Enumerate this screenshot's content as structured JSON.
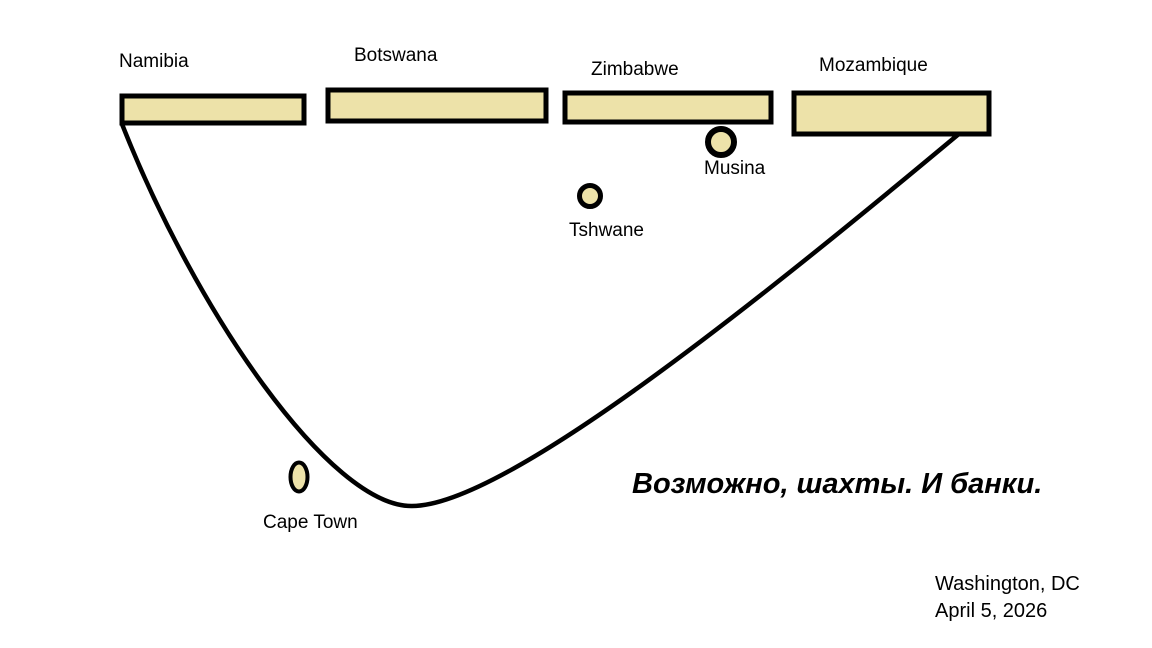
{
  "colors": {
    "shape_fill": "#EDE2A9",
    "stroke": "#000000",
    "background": "#FFFFFF",
    "text": "#000000"
  },
  "countries": [
    {
      "name": "Namibia"
    },
    {
      "name": "Botswana"
    },
    {
      "name": "Zimbabwe"
    },
    {
      "name": "Mozambique"
    }
  ],
  "cities": [
    {
      "name": "Musina"
    },
    {
      "name": "Tshwane"
    },
    {
      "name": "Cape Town"
    }
  ],
  "annotation": "Возможно, шахты. И банки.",
  "footer": {
    "location": "Washington, DC",
    "date": "April 5, 2026"
  }
}
